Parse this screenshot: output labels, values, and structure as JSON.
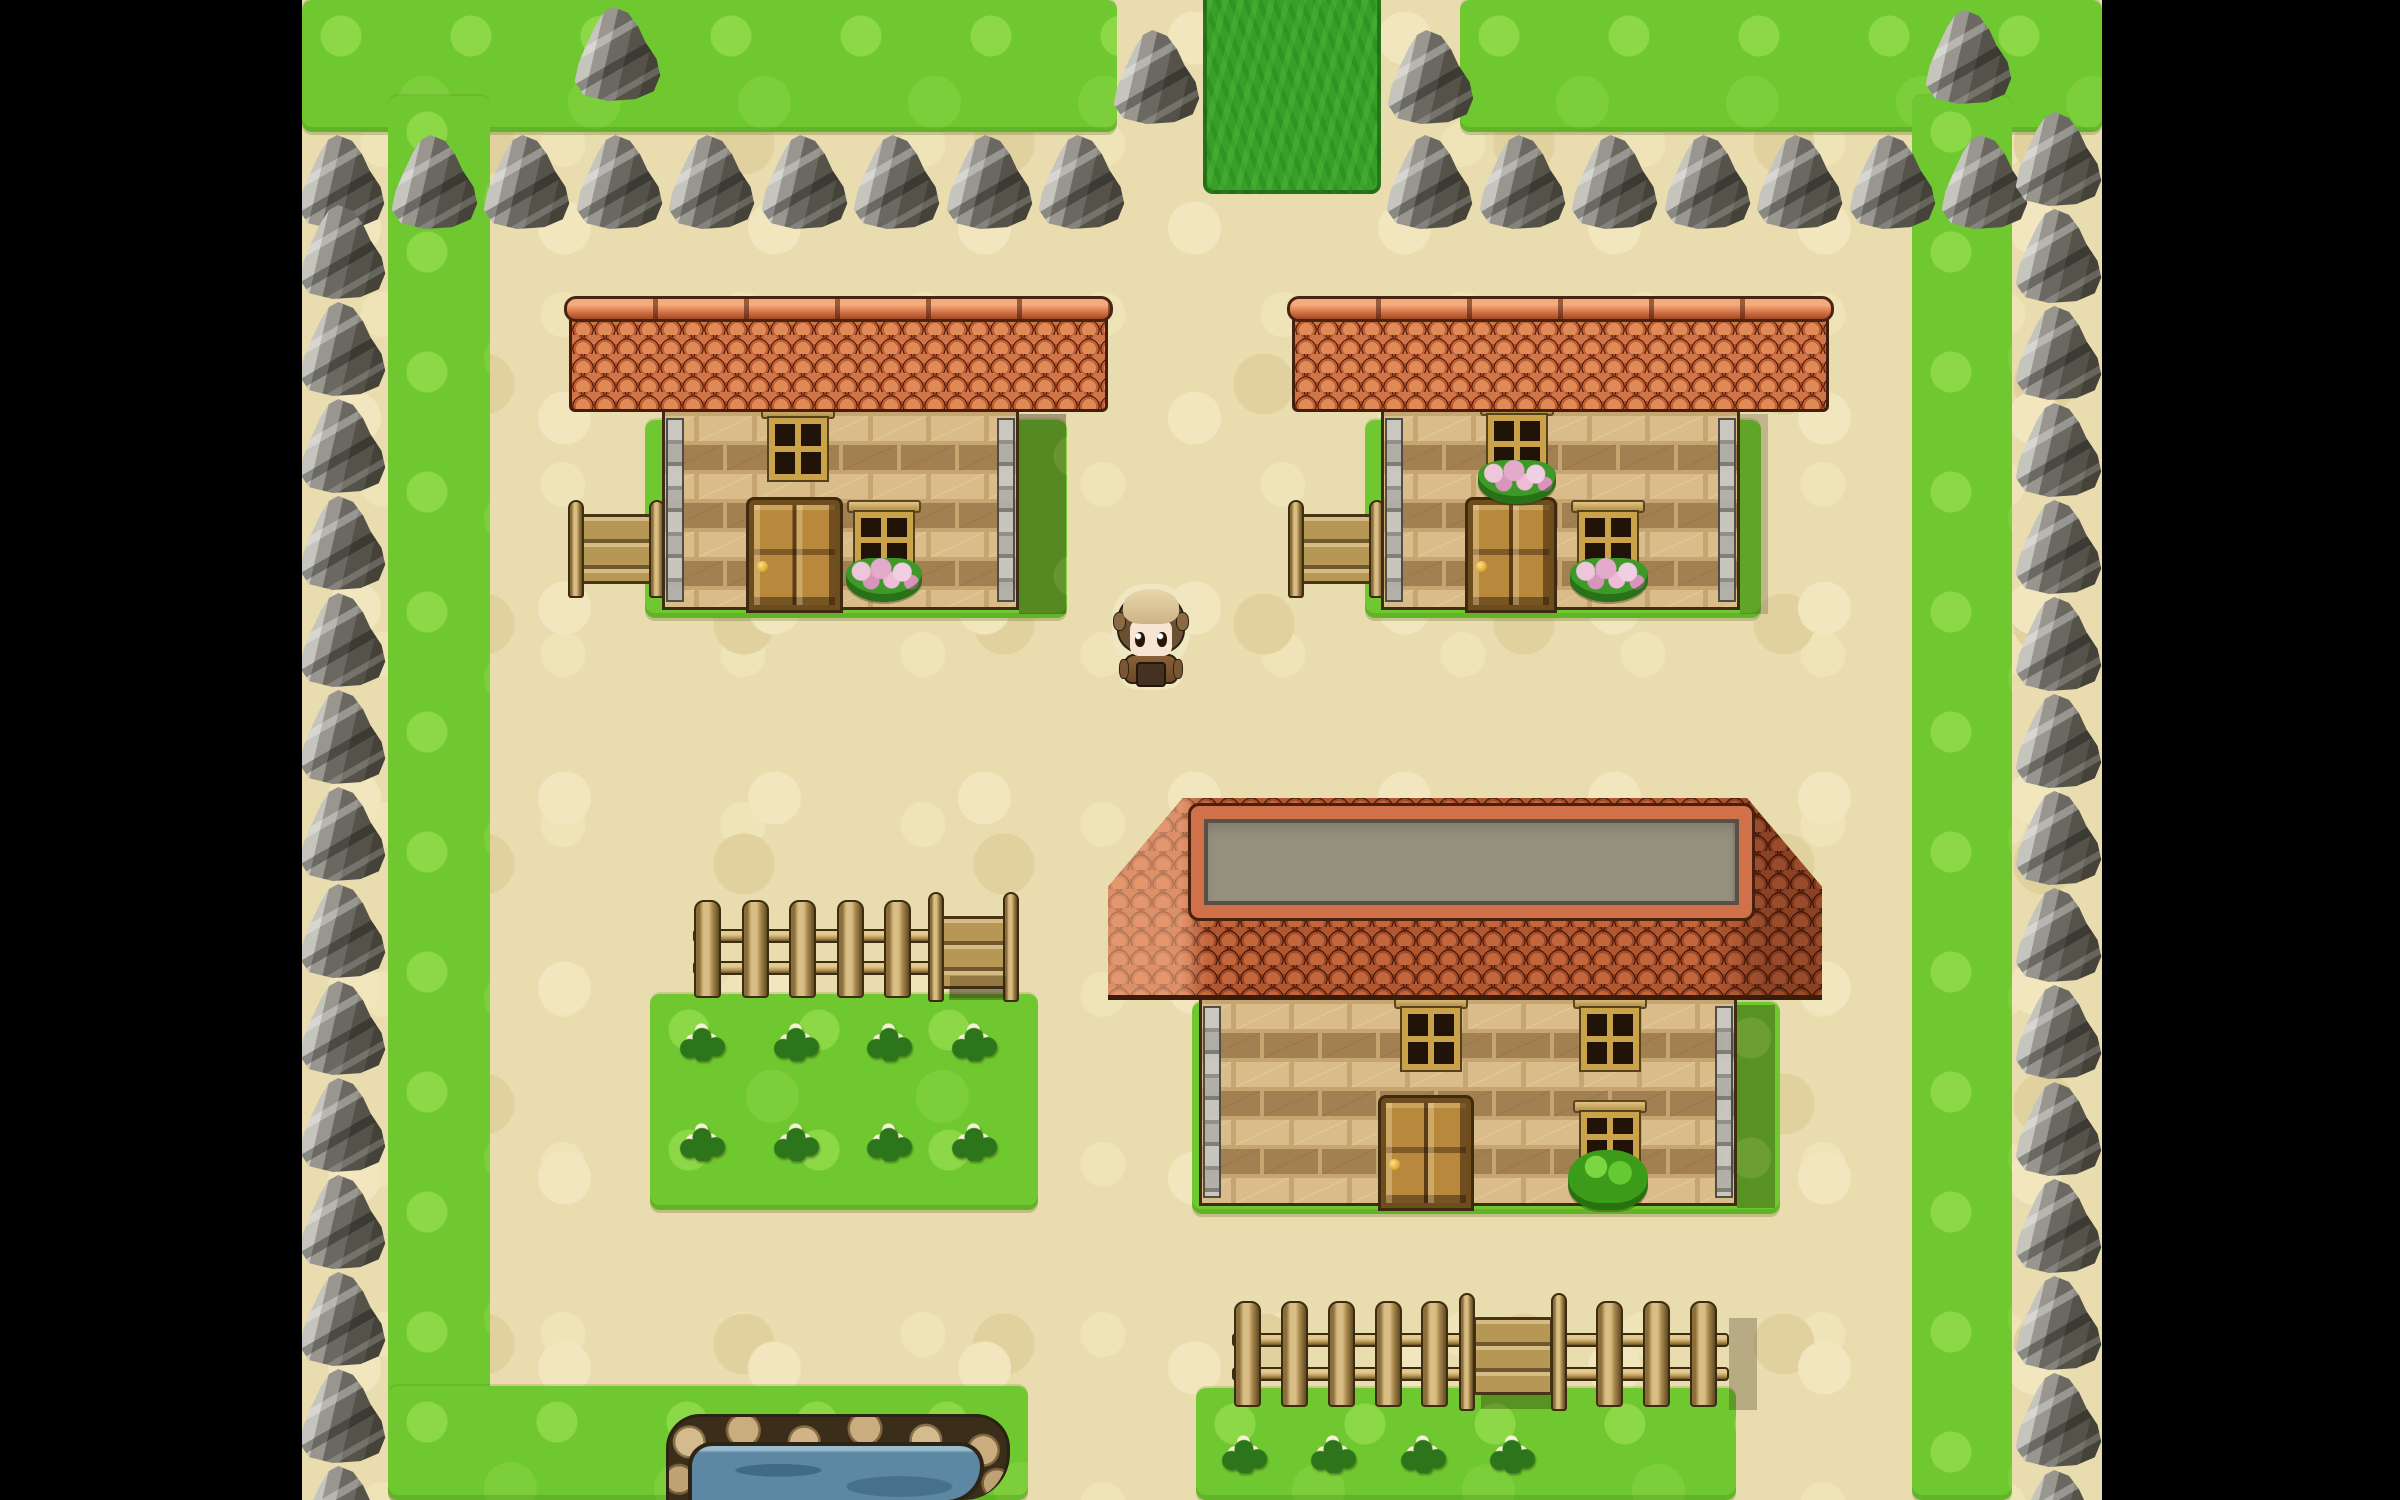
{
  "scene": {
    "width": 2400,
    "height": 1500,
    "style": "top-down-rpg-village",
    "hud_text": "none"
  },
  "palette": {
    "letterbox": "#000000",
    "path": "#e9dcae",
    "grass": "#6fc82f",
    "dark_grass": "#38a028",
    "rock_light": "#ecebe4",
    "rock_dark": "#454339",
    "roof_orange": "#c05e34",
    "roof_dark": "#94401f",
    "roof_plateau_gray": "#96907f",
    "wall_brick": "#c7a571",
    "wood": "#b79756",
    "water": "#5d88a4",
    "pond_stone": "#c9ad7e",
    "flower_pink": "#e3aacb",
    "flower_white": "#f6f2d6"
  },
  "viewport": {
    "x": 302,
    "y": 0,
    "w": 1800,
    "h": 1500
  },
  "letterbox": {
    "left": {
      "x": 0,
      "y": 0,
      "w": 302,
      "h": 1500
    },
    "right": {
      "x": 2102,
      "y": 0,
      "w": 298,
      "h": 1500
    }
  },
  "terrain": {
    "patches": [
      {
        "id": "grass-top-left",
        "x": 302,
        "y": 0,
        "w": 815,
        "h": 132
      },
      {
        "id": "grass-top-right",
        "x": 1460,
        "y": 0,
        "w": 642,
        "h": 132
      },
      {
        "id": "grass-border-left",
        "x": 388,
        "y": 96,
        "w": 102,
        "h": 1404
      },
      {
        "id": "grass-border-right",
        "x": 1912,
        "y": 96,
        "w": 100,
        "h": 1404
      },
      {
        "id": "grass-bottom-left",
        "x": 388,
        "y": 1386,
        "w": 640,
        "h": 114
      },
      {
        "id": "grass-pad-house-top-left",
        "x": 645,
        "y": 420,
        "w": 422,
        "h": 198
      },
      {
        "id": "grass-pad-house-top-right",
        "x": 1365,
        "y": 420,
        "w": 396,
        "h": 198
      },
      {
        "id": "grass-pad-house-big",
        "x": 1192,
        "y": 1002,
        "w": 588,
        "h": 212
      },
      {
        "id": "grass-garden-left",
        "x": 650,
        "y": 994,
        "w": 388,
        "h": 216
      },
      {
        "id": "grass-garden-bottom",
        "x": 1196,
        "y": 1388,
        "w": 540,
        "h": 112
      }
    ],
    "exit_path": {
      "id": "path-exit-top",
      "x": 1203,
      "y": 0,
      "w": 178,
      "h": 194
    }
  },
  "pond": {
    "stones": {
      "x": 666,
      "y": 1414,
      "w": 344,
      "h": 86
    },
    "water": {
      "x": 692,
      "y": 1446,
      "w": 288,
      "h": 54
    }
  },
  "flowers": {
    "cluster_size": 48,
    "white_clusters": [
      [
        678,
        1019
      ],
      [
        772,
        1019
      ],
      [
        865,
        1019
      ],
      [
        950,
        1019
      ],
      [
        678,
        1119
      ],
      [
        772,
        1119
      ],
      [
        865,
        1119
      ],
      [
        950,
        1119
      ],
      [
        1220,
        1431
      ],
      [
        1309,
        1431
      ],
      [
        1399,
        1431
      ],
      [
        1488,
        1431
      ]
    ]
  },
  "fences": [
    {
      "id": "fence-garden-left",
      "x": 693,
      "y": 900,
      "w": 325,
      "h": 98,
      "posts": [
        694,
        742,
        789,
        837,
        884
      ],
      "gate": {
        "post_left": 928,
        "panel_x": 941,
        "panel_w": 66,
        "post_right": 1003,
        "post_w": 16
      }
    },
    {
      "id": "fence-garden-bottom",
      "x": 1232,
      "y": 1301,
      "w": 497,
      "h": 106,
      "posts": [
        1234,
        1281,
        1328,
        1375,
        1421,
        1596,
        1643,
        1690
      ],
      "gate": {
        "post_left": 1459,
        "panel_x": 1473,
        "panel_w": 80,
        "post_right": 1551,
        "post_w": 16
      }
    }
  ],
  "houses": [
    {
      "id": "house-top-left",
      "bench": {
        "x": 568,
        "y": 500,
        "w": 97,
        "h": 98
      },
      "wall": {
        "x": 662,
        "y": 410,
        "w": 357,
        "h": 200
      },
      "windows": [
        {
          "x": 769,
          "y": 418,
          "w": 58,
          "h": 62
        },
        {
          "x": 855,
          "y": 512,
          "w": 58,
          "h": 56
        }
      ],
      "door": {
        "x": 749,
        "y": 500,
        "w": 91,
        "h": 110
      },
      "flowerboxes": [
        {
          "x": 846,
          "y": 558,
          "w": 76,
          "h": 44
        }
      ],
      "shadow": {
        "x": 1019,
        "y": 414,
        "w": 47,
        "h": 200,
        "opacity": 0.35
      },
      "roof": {
        "kind": "flat",
        "x": 569,
        "y": 298,
        "w": 539,
        "h": 114
      }
    },
    {
      "id": "house-top-right",
      "bench": {
        "x": 1288,
        "y": 500,
        "w": 97,
        "h": 98
      },
      "wall": {
        "x": 1381,
        "y": 410,
        "w": 359,
        "h": 200
      },
      "windows": [
        {
          "x": 1488,
          "y": 415,
          "w": 58,
          "h": 58
        },
        {
          "x": 1579,
          "y": 512,
          "w": 58,
          "h": 56
        }
      ],
      "door": {
        "x": 1468,
        "y": 500,
        "w": 86,
        "h": 110
      },
      "flowerboxes": [
        {
          "x": 1478,
          "y": 460,
          "w": 78,
          "h": 44
        },
        {
          "x": 1570,
          "y": 558,
          "w": 78,
          "h": 44
        }
      ],
      "shadow": {
        "x": 1740,
        "y": 414,
        "w": 28,
        "h": 200,
        "opacity": 0.2
      },
      "roof": {
        "kind": "flat",
        "x": 1292,
        "y": 298,
        "w": 537,
        "h": 114
      }
    },
    {
      "id": "house-big",
      "wall": {
        "x": 1199,
        "y": 998,
        "w": 538,
        "h": 208
      },
      "windows": [
        {
          "x": 1402,
          "y": 1008,
          "w": 58,
          "h": 62
        },
        {
          "x": 1581,
          "y": 1008,
          "w": 58,
          "h": 62
        },
        {
          "x": 1581,
          "y": 1112,
          "w": 58,
          "h": 50
        }
      ],
      "door": {
        "x": 1381,
        "y": 1098,
        "w": 90,
        "h": 110
      },
      "bush": {
        "x": 1568,
        "y": 1150,
        "w": 80,
        "h": 60
      },
      "shadow": {
        "x": 1737,
        "y": 1005,
        "w": 38,
        "h": 203,
        "opacity": 0.3
      },
      "roof": {
        "kind": "hip",
        "x": 1108,
        "y": 798,
        "w": 714,
        "h": 202,
        "top_left_frac": 0.105,
        "top_right_frac": 0.895,
        "corner_y_frac": 0.44,
        "plateau": {
          "x": 1191,
          "y": 806,
          "w": 561,
          "h": 112
        }
      }
    }
  ],
  "ground_shadows": [
    {
      "x": 950,
      "y": 976,
      "w": 56,
      "h": 22,
      "opacity": 0.25
    },
    {
      "x": 1729,
      "y": 1318,
      "w": 28,
      "h": 92,
      "opacity": 0.25
    }
  ],
  "rocks": {
    "size": {
      "w": 92,
      "h": 98
    },
    "top_row": {
      "y": 133,
      "xs": [
        295,
        388,
        480,
        573,
        665,
        758,
        850,
        943,
        1035,
        1383,
        1476,
        1568,
        1661,
        1753,
        1846,
        1938
      ]
    },
    "left_column": {
      "x": 296,
      "ys": [
        203,
        300,
        397,
        494,
        591,
        688,
        785,
        882,
        979,
        1076,
        1173,
        1270,
        1367,
        1464
      ]
    },
    "right_column": {
      "x": 2012,
      "ys": [
        110,
        207,
        304,
        401,
        498,
        595,
        692,
        789,
        886,
        983,
        1080,
        1177,
        1274,
        1371,
        1468
      ]
    },
    "extras": [
      {
        "x": 571,
        "y": 5
      },
      {
        "x": 1110,
        "y": 28
      },
      {
        "x": 1384,
        "y": 28
      },
      {
        "x": 1922,
        "y": 8
      }
    ]
  },
  "player": {
    "x": 1114,
    "y": 586,
    "w": 74,
    "h": 102,
    "facing": "down"
  }
}
